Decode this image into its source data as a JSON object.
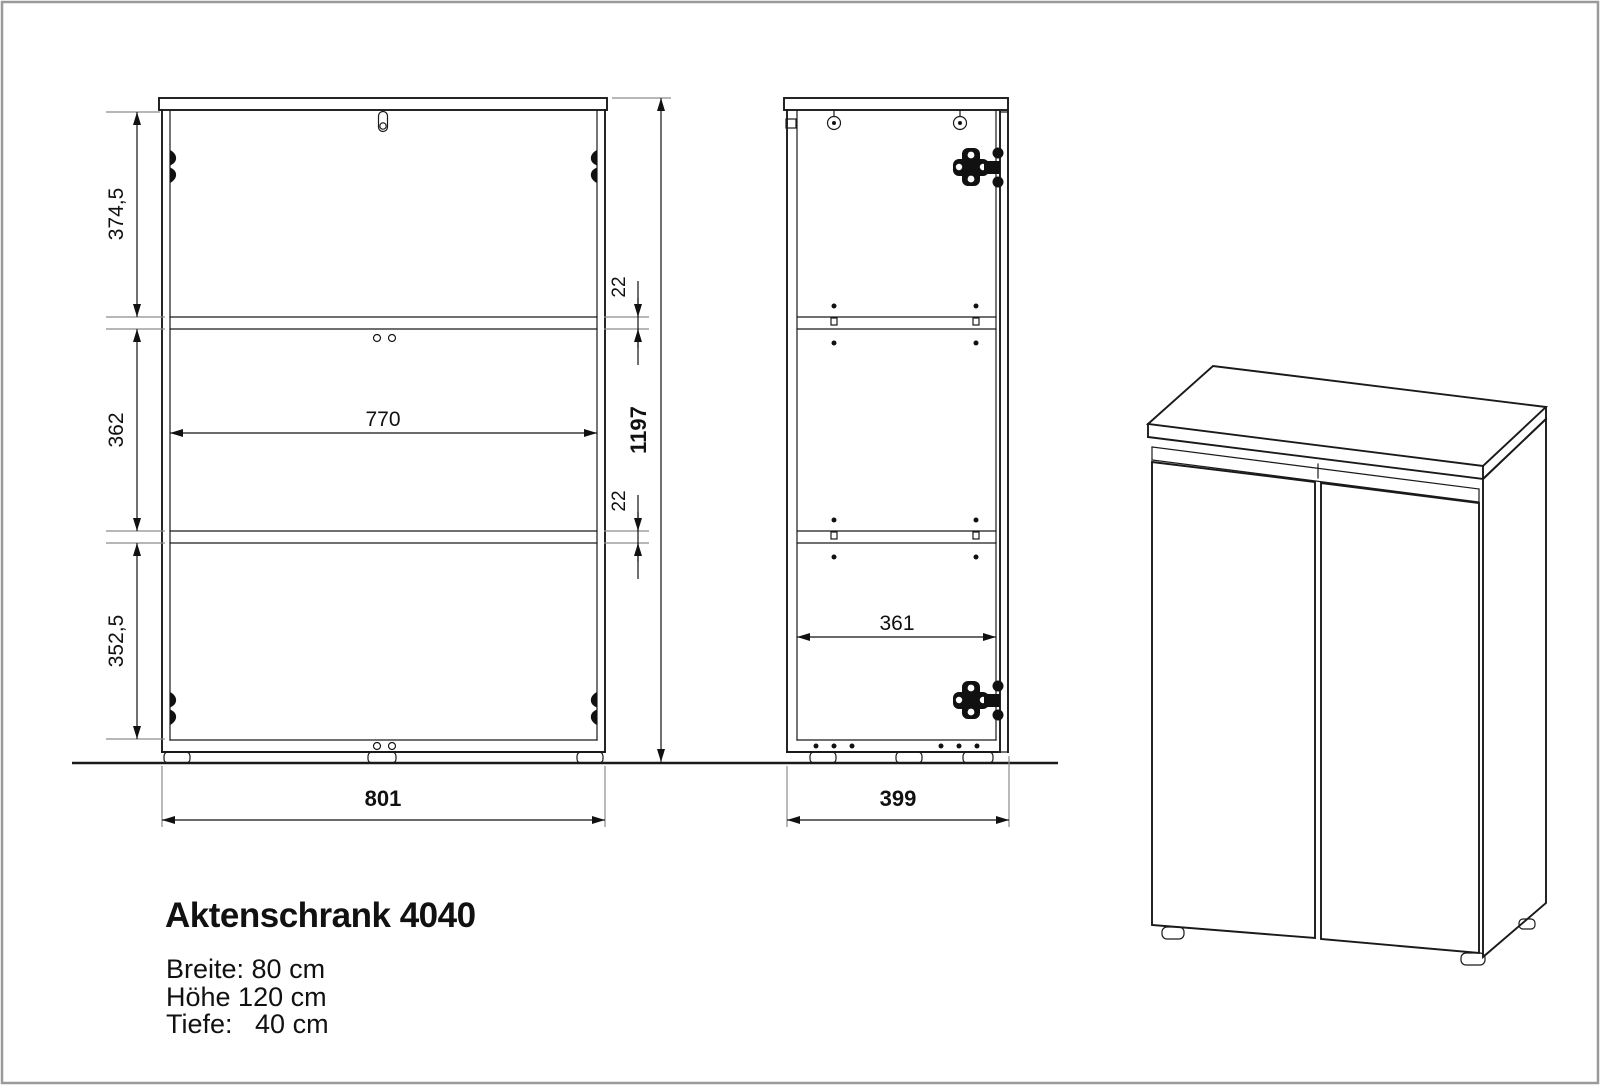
{
  "page": {
    "background": "#ffffff",
    "border_color": "#9a9a9a"
  },
  "colors": {
    "drawing_line": "#1a1a1a",
    "extension_line": "#8c8c8c",
    "text": "#111111"
  },
  "title_block": {
    "title": "Aktenschrank 4040",
    "spec_line1": "Breite: 80 cm",
    "spec_line2": "Höhe 120 cm",
    "spec_line3": "Tiefe:   40 cm"
  },
  "front_view": {
    "dim_section_top": "374,5",
    "dim_section_middle": "362",
    "dim_section_bottom": "352,5",
    "dim_inner_width": "770",
    "dim_shelf_upper": "22",
    "dim_shelf_lower": "22",
    "dim_overall_height": "1197",
    "dim_overall_width": "801"
  },
  "side_view": {
    "dim_inner_depth": "361",
    "dim_overall_depth": "399"
  }
}
